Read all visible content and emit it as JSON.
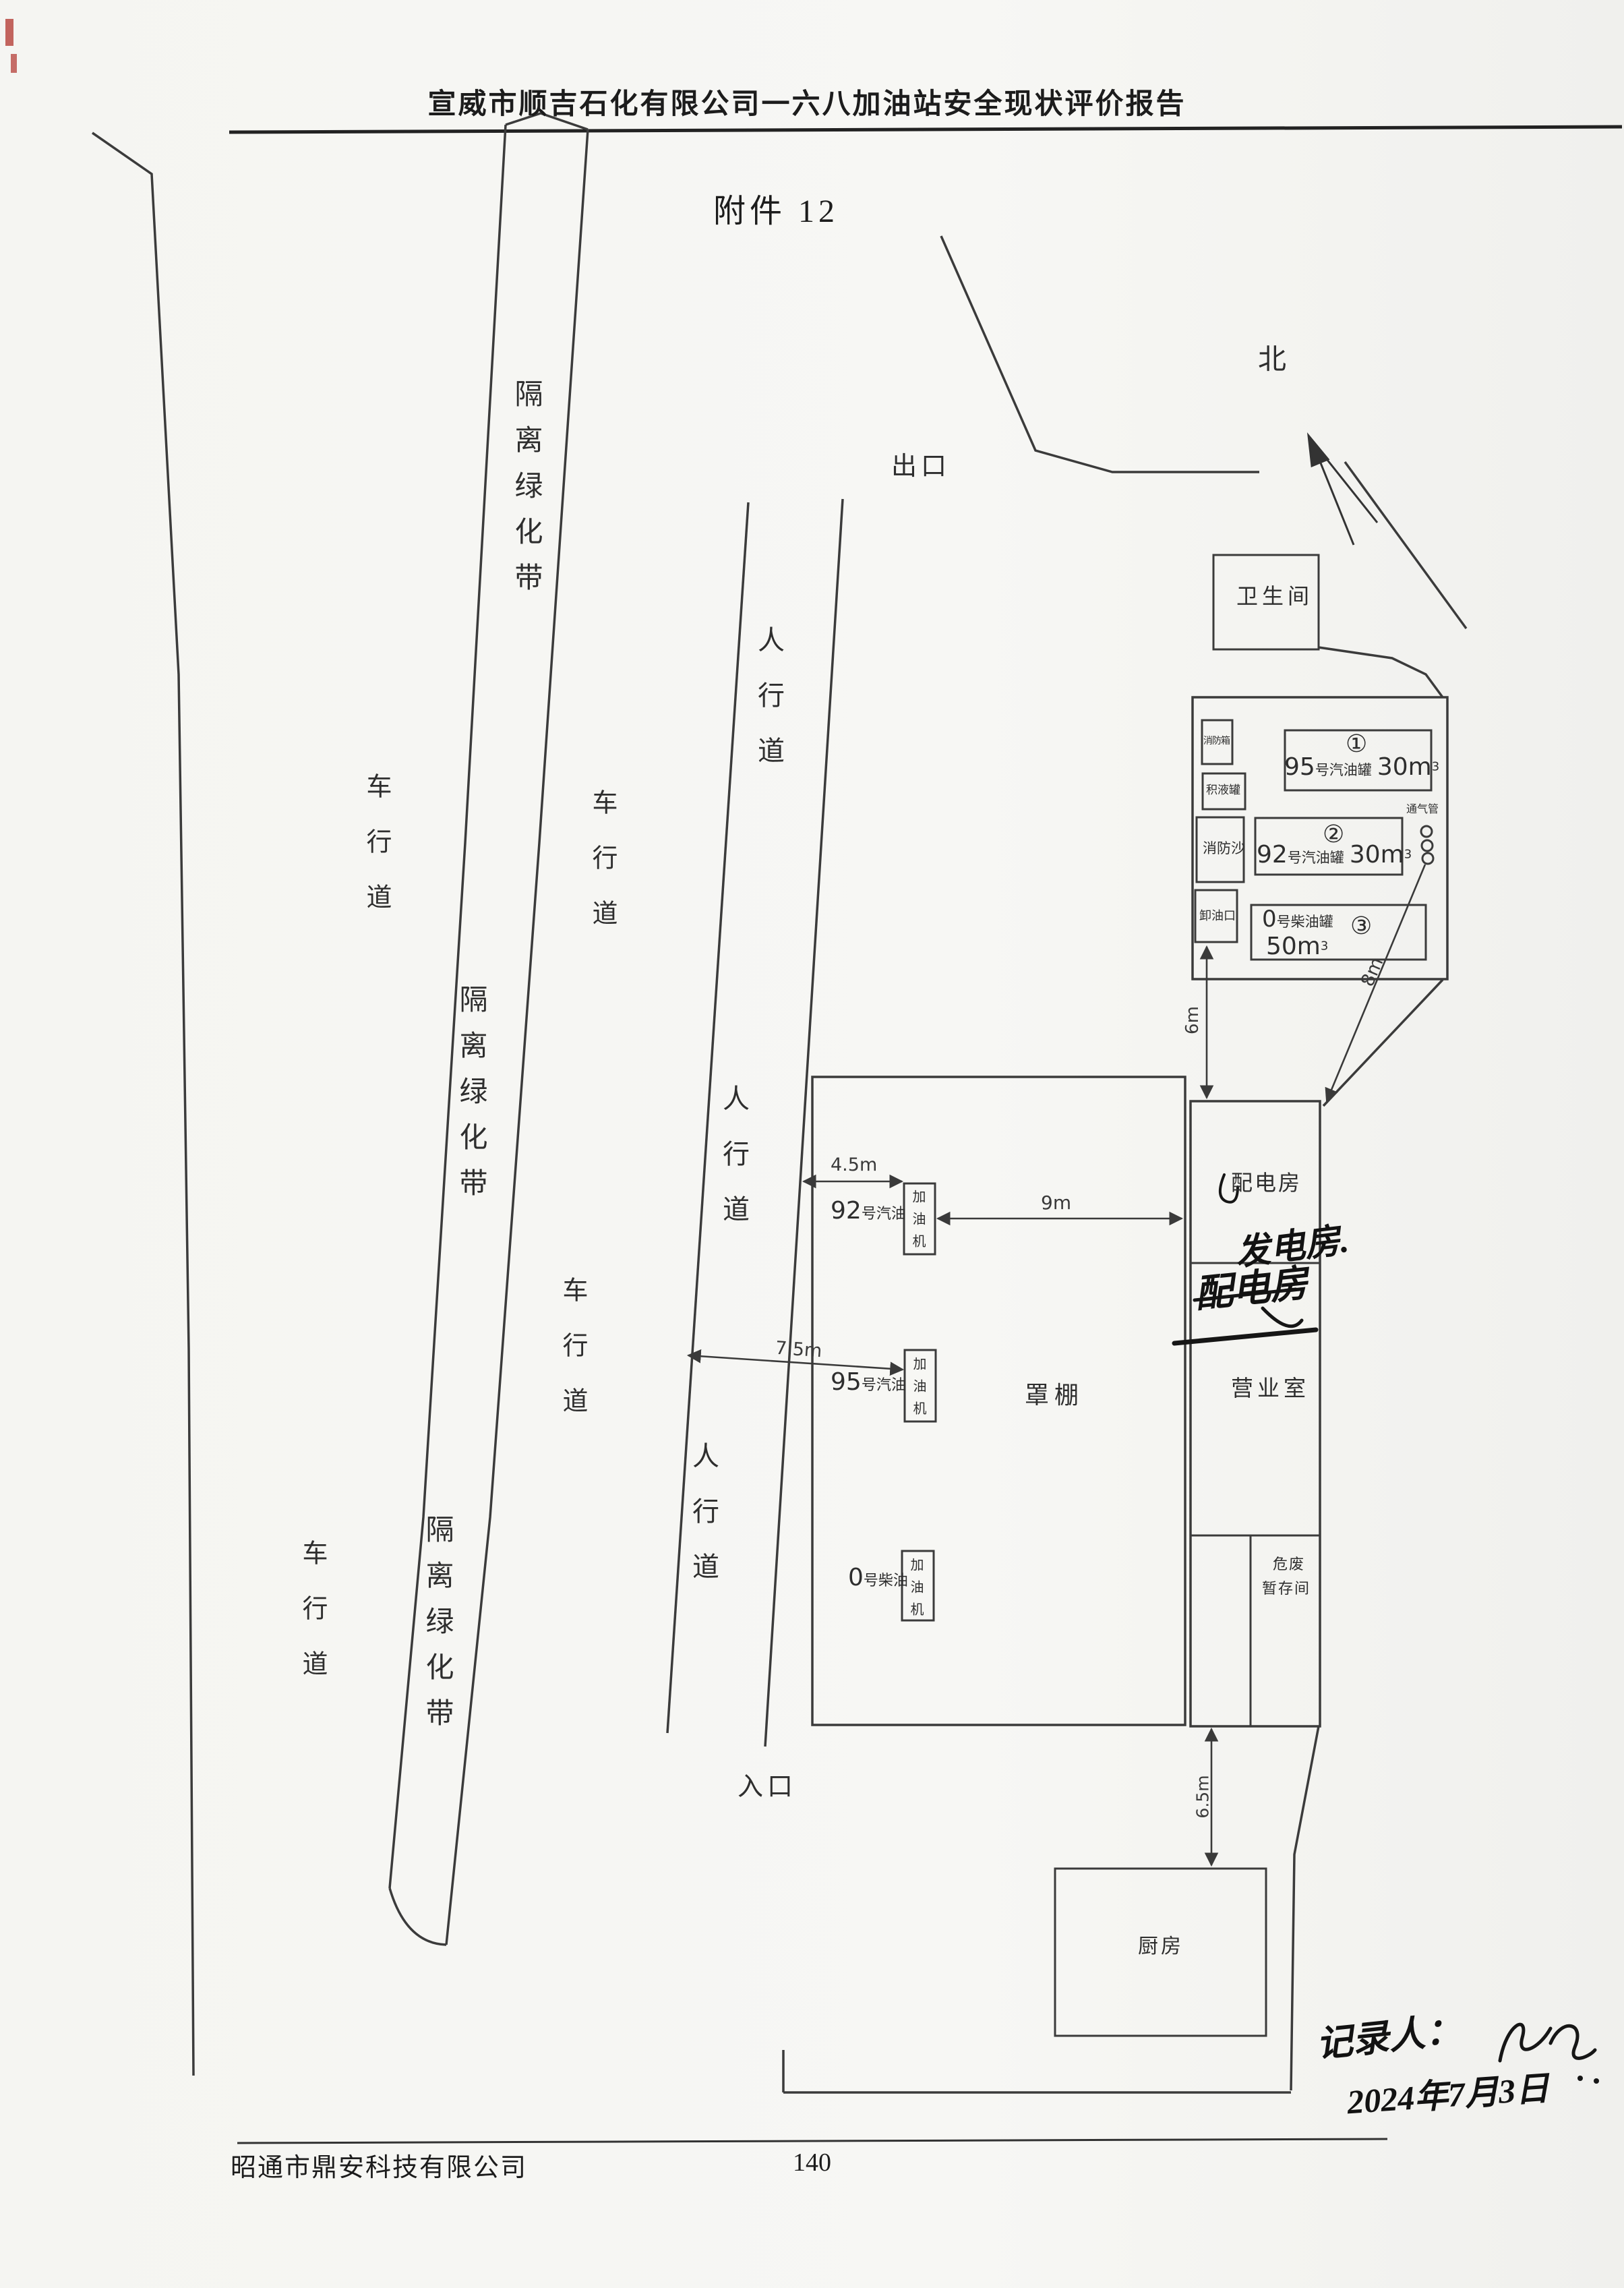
{
  "page": {
    "header_title": "宣威市顺吉石化有限公司一六八加油站安全现状评价报告",
    "attachment_title": "附件 12",
    "footer_company": "昭通市鼎安科技有限公司",
    "page_number": "140"
  },
  "colors": {
    "ink": "#2e2e2e",
    "paper": "#f6f6f3",
    "scan_mark_red": "#b94a44"
  },
  "labels": {
    "north": "北",
    "exit": "出口",
    "entrance": "入口",
    "lane": "车行道",
    "greenbelt": "隔离绿化带",
    "sidewalk": "人行道",
    "restroom": "卫生间",
    "canopy": "罩棚",
    "kitchen": "厨房",
    "power_room": "配电房",
    "business_room": "营业室",
    "hazwaste_line1": "危废",
    "hazwaste_line2": "暂存间",
    "vent_pipe": "通气管",
    "fire_cabinet": "消防箱",
    "liquid_trap_tank": "积液罐",
    "fire_sand": "消防沙",
    "unload_port": "卸油口"
  },
  "tanks": [
    {
      "id": "①",
      "num": "95",
      "name": "号汽油罐",
      "vol": "30m",
      "sup": "3"
    },
    {
      "id": "②",
      "num": "92",
      "name": "号汽油罐",
      "vol": "30m",
      "sup": "3"
    },
    {
      "id": "③",
      "num": "0",
      "name": "号柴油罐",
      "vol": "50m",
      "sup": "3"
    }
  ],
  "dispensers": [
    {
      "num": "92",
      "name": "号汽油",
      "unit": "加油机"
    },
    {
      "num": "95",
      "name": "号汽油",
      "unit": "加油机"
    },
    {
      "num": "0",
      "name": "号柴油",
      "unit": "加油机"
    }
  ],
  "dimensions": {
    "sidewalk_to_disp1": "4.5m",
    "disp_to_building": "9m",
    "sidewalk_to_disp2": "7.5m",
    "unload_to_building": "6m",
    "vent_to_building": "8m",
    "building_to_kitchen": "6.5m"
  },
  "handwriting": {
    "power_note": "发电房.",
    "power_note_struck": "配电房",
    "recorder_label": "记录人：",
    "date": "2024年7月3日"
  }
}
